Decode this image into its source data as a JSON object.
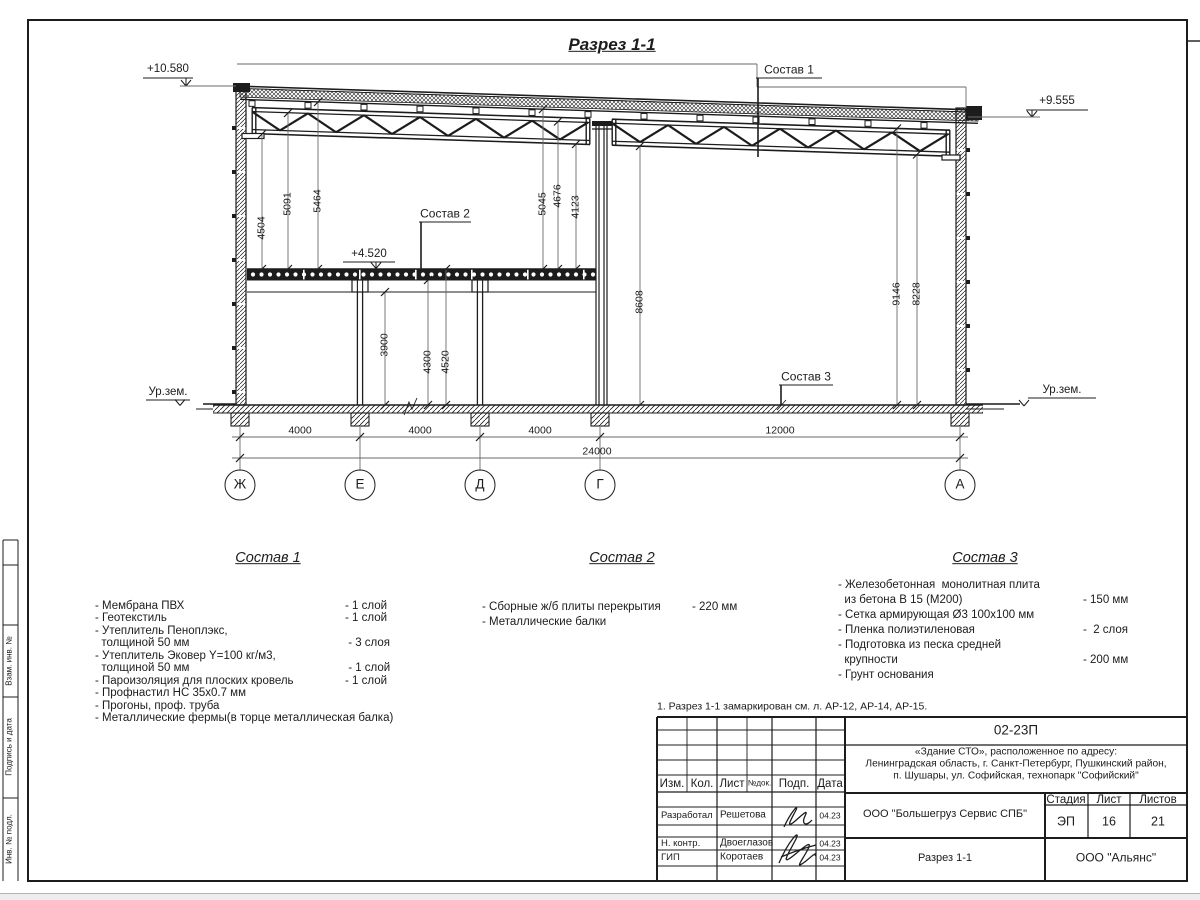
{
  "colors": {
    "ink": "#1c1c1c",
    "dim_line": "#6a6a6a",
    "paper": "#ffffff",
    "backdrop": "#ededed"
  },
  "drawing": {
    "title": "Разрез 1-1",
    "elevation_marks": [
      {
        "name": "elevation-top-left",
        "text": "+10.580",
        "x": 168,
        "y": 69
      },
      {
        "name": "elevation-top-right",
        "text": "+9.555",
        "x": 1057,
        "y": 101
      },
      {
        "name": "elevation-floor",
        "text": "+4.520",
        "x": 369,
        "y": 254
      },
      {
        "name": "ground-level-left",
        "text": "Ур.зем.",
        "x": 168,
        "y": 392
      },
      {
        "name": "ground-level-right",
        "text": "Ур.зем.",
        "x": 1062,
        "y": 390
      }
    ],
    "leader_labels": [
      {
        "name": "sostav-1-leader",
        "text": "Состав 1",
        "x": 789,
        "y": 70
      },
      {
        "name": "sostav-2-leader",
        "text": "Состав 2",
        "x": 445,
        "y": 214
      },
      {
        "name": "sostav-3-leader",
        "text": "Состав 3",
        "x": 806,
        "y": 377
      }
    ],
    "vertical_dims": [
      {
        "text": "4504",
        "x": 262,
        "y": 228
      },
      {
        "text": "5091",
        "x": 288,
        "y": 204
      },
      {
        "text": "5464",
        "x": 318,
        "y": 201
      },
      {
        "text": "5045",
        "x": 543,
        "y": 204
      },
      {
        "text": "4676",
        "x": 558,
        "y": 196
      },
      {
        "text": "4123",
        "x": 576,
        "y": 207
      },
      {
        "text": "3900",
        "x": 385,
        "y": 345
      },
      {
        "text": "4300",
        "x": 428,
        "y": 362
      },
      {
        "text": "4520",
        "x": 446,
        "y": 362
      },
      {
        "text": "8608",
        "x": 640,
        "y": 302
      },
      {
        "text": "9146",
        "x": 897,
        "y": 294
      },
      {
        "text": "8228",
        "x": 917,
        "y": 294
      }
    ],
    "horizontal_dims": [
      {
        "text": "4000",
        "x": 300,
        "y": 431
      },
      {
        "text": "4000",
        "x": 420,
        "y": 431
      },
      {
        "text": "4000",
        "x": 540,
        "y": 431
      },
      {
        "text": "12000",
        "x": 780,
        "y": 431
      },
      {
        "text": "24000",
        "x": 597,
        "y": 452
      }
    ],
    "axes": [
      {
        "label": "Ж",
        "x": 240
      },
      {
        "label": "Е",
        "x": 360
      },
      {
        "label": "Д",
        "x": 480
      },
      {
        "label": "Г",
        "x": 600
      },
      {
        "label": "А",
        "x": 960
      }
    ]
  },
  "compositions": [
    {
      "heading": "Состав 1",
      "heading_x": 268,
      "heading_y": 559,
      "x": 95,
      "value_x": 345,
      "y": 606,
      "lh": 12.45,
      "rows": [
        {
          "text": "- Мембрана ПВХ",
          "value": "- 1 слой"
        },
        {
          "text": "- Геотекстиль",
          "value": "- 1 слой"
        },
        {
          "text": "- Утеплитель Пеноплэкс,",
          "value": ""
        },
        {
          "text": "  толщиной 50 мм",
          "value": " - 3 слоя"
        },
        {
          "text": "- Утеплитель Эковер Y=100 кг/м3,",
          "value": ""
        },
        {
          "text": "  толщиной 50 мм",
          "value": " - 1 слой"
        },
        {
          "text": "- Пароизоляция для плоских кровель",
          "value": "- 1 слой"
        },
        {
          "text": "- Профнастил НС 35х0.7 мм",
          "value": ""
        },
        {
          "text": "- Прогоны, проф. труба",
          "value": ""
        },
        {
          "text": "- Металлические фермы(в торце металлическая балка)",
          "value": ""
        }
      ]
    },
    {
      "heading": "Состав 2",
      "heading_x": 622,
      "heading_y": 559,
      "x": 482,
      "value_x": 692,
      "y": 607,
      "lh": 15,
      "rows": [
        {
          "text": "- Сборные ж/б плиты перекрытия",
          "value": "- 220 мм"
        },
        {
          "text": "- Металлические балки",
          "value": ""
        }
      ]
    },
    {
      "heading": "Состав 3",
      "heading_x": 985,
      "heading_y": 559,
      "x": 838,
      "value_x": 1083,
      "y": 585,
      "lh": 15,
      "rows": [
        {
          "text": "- Железобетонная  монолитная плита",
          "value": ""
        },
        {
          "text": "  из бетона В 15 (М200)",
          "value": "- 150 мм"
        },
        {
          "text": "- Сетка армирующая Ø3 100х100 мм",
          "value": ""
        },
        {
          "text": "- Пленка полиэтиленовая",
          "value": "-  2 слоя"
        },
        {
          "text": "- Подготовка из песка средней",
          "value": ""
        },
        {
          "text": "  крупности",
          "value": "- 200 мм"
        },
        {
          "text": "- Грунт основания",
          "value": ""
        }
      ]
    }
  ],
  "note": "1. Разрез 1-1 замаркирован см. л. АР-12, АР-14, АР-15.",
  "frame": {
    "margin_labels": [
      {
        "text": "Взам. инв. №",
        "y": 661
      },
      {
        "text": "Подпись и дата",
        "y": 747
      },
      {
        "text": "Инв. № подл.",
        "y": 839
      }
    ]
  },
  "titleblock": {
    "doc_number": "02-23П",
    "project_lines": [
      "«Здание СТО», расположенное по адресу:",
      "Ленинградская область, г. Санкт-Петербург, Пушкинский район,",
      "п. Шушары, ул. Софийская, технопарк \"Софийский\""
    ],
    "client": "ООО \"Большегруз Сервис СПБ\"",
    "stage_label": "Стадия",
    "sheet_label": "Лист",
    "sheets_label": "Листов",
    "stage": "ЭП",
    "sheet": "16",
    "sheets": "21",
    "drawing_name": "Разрез 1-1",
    "company": "ООО \"Альянс\"",
    "header_cols": [
      "Изм.",
      "Кол.",
      "Лист",
      "№док.",
      "Подп.",
      "Дата"
    ],
    "people": [
      {
        "role": "Разработал",
        "name": "Решетова",
        "date": "04.23"
      },
      {
        "role": "Н. контр.",
        "name": "Двоеглазов",
        "date": "04.23"
      },
      {
        "role": "ГИП",
        "name": "Коротаев",
        "date": "04.23"
      }
    ]
  }
}
